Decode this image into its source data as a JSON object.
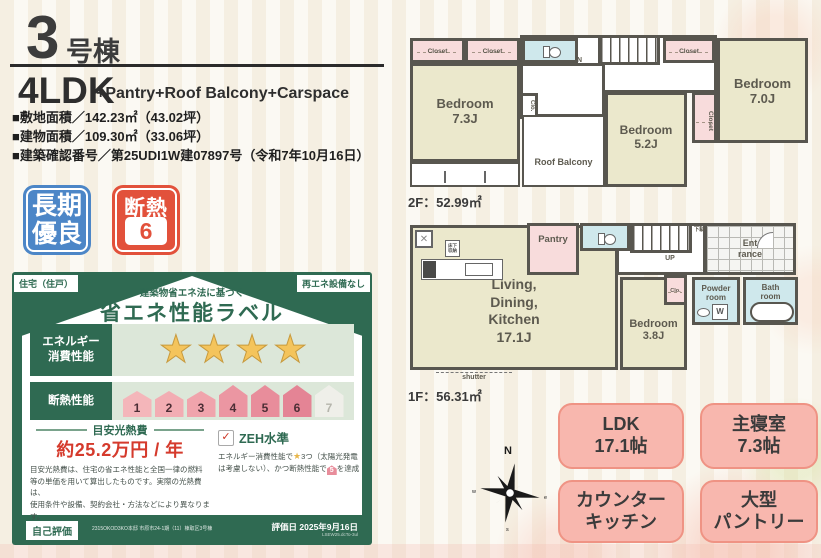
{
  "colors": {
    "badge_blue": "#4c86c7",
    "badge_red": "#e2513b",
    "card_green": "#2f6a52",
    "accent_pink": "#f8b7ae",
    "star_gold": "#f4c45c",
    "cost_red": "#d53a2c"
  },
  "header": {
    "number": "3",
    "suffix": "号棟",
    "plan": "4LDK",
    "plan_features": "+Pantry+Roof Balcony+Carspace",
    "spec_lines": [
      "■敷地面積／142.23㎡（43.02坪）",
      "■建物面積／109.30㎡（33.06坪）",
      "■建築確認番号／第25UDI1W建07897号（令和7年10月16日）"
    ]
  },
  "badges": {
    "long_term_line1": "長期",
    "long_term_line2": "優良",
    "insulation_label": "断熱",
    "insulation_grade": "6"
  },
  "energy_label": {
    "housing_tag": "住宅（住戸）",
    "renewable_tag": "再エネ設備なし",
    "law_note": "建築物省エネ法に基づく",
    "title": "省エネ性能ラベル",
    "energy_row_label_1": "エネルギー",
    "energy_row_label_2": "消費性能",
    "stars": [
      "★",
      "★",
      "★",
      "★"
    ],
    "insulation_row_label": "断熱性能",
    "insulation_levels": [
      "1",
      "2",
      "3",
      "4",
      "5",
      "6",
      "7"
    ],
    "cost_header": "目安光熱費",
    "cost_value": "約25.2万円 / 年",
    "cost_notes": [
      "目安光熱費は、住宅の省エネ性能と全国一律の燃料",
      "等の単価を用いて算出したものです。実際の光熱費は、",
      "使用条件や設備、契約会社・方法などにより異なります。"
    ],
    "zeh_check": "✓",
    "zeh_label": "ZEH水準",
    "zeh_note_1": "エネルギー消費性能で",
    "zeh_star": "★",
    "zeh_note_2": "3つ（太陽光発電",
    "zeh_note_3": "は考慮しない）、かつ断熱性能で",
    "zeh_house": "5",
    "zeh_note_4": "を達成",
    "self_eval": "自己評価",
    "self_eval_note": "2315OKOD3KO本邸 市原市24-1期（11）棟取区3号棟",
    "eval_date": "評価日 2025年9月16日",
    "eval_code": "LSEW25.dcTo-3ul"
  },
  "floor2": {
    "area": "2F：52.99㎡",
    "rooms": {
      "closet": "Closet",
      "clo": "Clo.",
      "dn": "DN",
      "bedroom73_name": "Bedroom",
      "bedroom73_size": "7.3J",
      "bedroom52_name": "Bedroom",
      "bedroom52_size": "5.2J",
      "bedroom70_name": "Bedroom",
      "bedroom70_size": "7.0J",
      "roof_balcony": "Roof Balcony"
    }
  },
  "floor1": {
    "area": "1F：56.31㎡",
    "rooms": {
      "ldk_lines": [
        "Living,",
        "Dining,",
        "Kitchen",
        "17.1J"
      ],
      "pantry": "Pantry",
      "bedroom38_name": "Bedroom",
      "bedroom38_size": "3.8J",
      "powder_1": "Powder",
      "powder_2": "room",
      "bath_1": "Bath",
      "bath_2": "room",
      "entrance_1": "Ent",
      "entrance_2": "rance",
      "up": "UP",
      "shoe_cabinet": "下駄箱",
      "floor_storage": "床下収納",
      "clo": "Clo.",
      "washer": "W",
      "shutter": "shutter"
    }
  },
  "features": [
    {
      "line1": "LDK",
      "line2": "17.1帖"
    },
    {
      "line1": "主寝室",
      "line2": "7.3帖"
    },
    {
      "line1": "カウンター",
      "line2": "キッチン"
    },
    {
      "line1": "大型",
      "line2": "パントリー"
    }
  ],
  "compass": {
    "n": "N",
    "w": "w",
    "e": "e",
    "s": "s"
  }
}
